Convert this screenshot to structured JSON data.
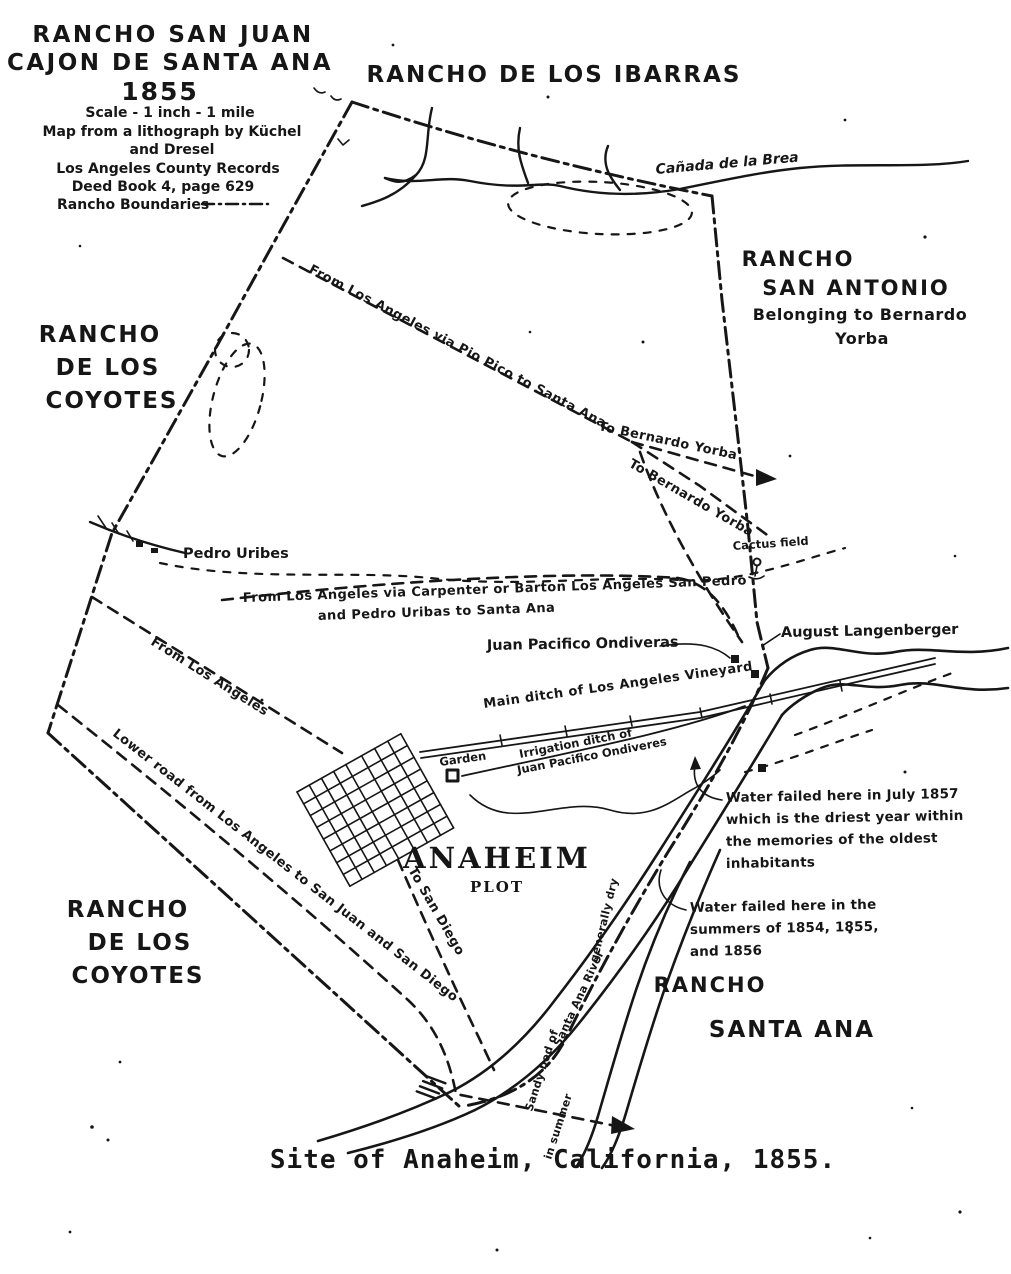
{
  "page": {
    "colors": {
      "paper": "#ffffff",
      "ink": "#161616"
    },
    "caption": "Site of Anaheim, California, 1855."
  },
  "title_block": {
    "line1": "RANCHO SAN JUAN",
    "line2": "CAJON DE SANTA ANA",
    "year": "1855",
    "details": [
      "Scale - 1 inch - 1 mile",
      "Map from a lithograph by Küchel",
      "and Dresel",
      "Los Angeles County Records",
      "Deed Book 4, page 629"
    ],
    "legend_label": "Rancho Boundaries"
  },
  "ranchos": {
    "ibarras": "RANCHO DE LOS IBARRAS",
    "san_antonio": [
      "RANCHO",
      "SAN ANTONIO",
      "Belonging to Bernardo",
      "Yorba"
    ],
    "coyotes_nw": [
      "RANCHO",
      "DE LOS",
      "COYOTES"
    ],
    "coyotes_sw": [
      "RANCHO",
      "DE LOS",
      "COYOTES"
    ],
    "santa_ana": [
      "RANCHO",
      "SANTA ANA"
    ]
  },
  "roads": {
    "pio_pico": "From Los Angeles via Pio Pico to Santa Ana",
    "to_bernardo_yorba_1": "To Bernardo Yorba",
    "to_bernardo_yorba_2": "To Bernardo Yorba",
    "carpenter": [
      "From Los Angeles via Carpenter or Barton Los Angeles San Pedro",
      "and Pedro Uribas to Santa Ana"
    ],
    "from_los_angeles": "From Los Angeles",
    "lower_road": "Lower road from Los Angeles to San Juan and San Diego",
    "to_san_diego": "To San Diego"
  },
  "features": {
    "canada_de_la_brea": "Cañada de la Brea",
    "pedro_uribes": "Pedro Uribes",
    "juan_pacifico_ondiveras": "Juan Pacifico Ondiveras",
    "august_langenberger": "August Langenberger",
    "cactus_field": "Cactus field",
    "main_ditch": "Main ditch of Los Angeles Vineyard",
    "irrigation_ditch": [
      "Irrigation ditch of",
      "Juan Pacifico Ondiveres"
    ],
    "garden": "Garden",
    "anaheim": [
      "ANAHEIM",
      "PLOT"
    ],
    "river_label": [
      "Sandy bed of",
      "Santa Ana River",
      "generally dry",
      "in summer"
    ]
  },
  "notes": {
    "water_1857": [
      "Water failed here in July 1857",
      "which is the driest year within",
      "the memories of the oldest",
      "inhabitants"
    ],
    "water_1854": [
      "Water failed here in the",
      "summers of 1854, 1855,",
      "and 1856"
    ]
  }
}
